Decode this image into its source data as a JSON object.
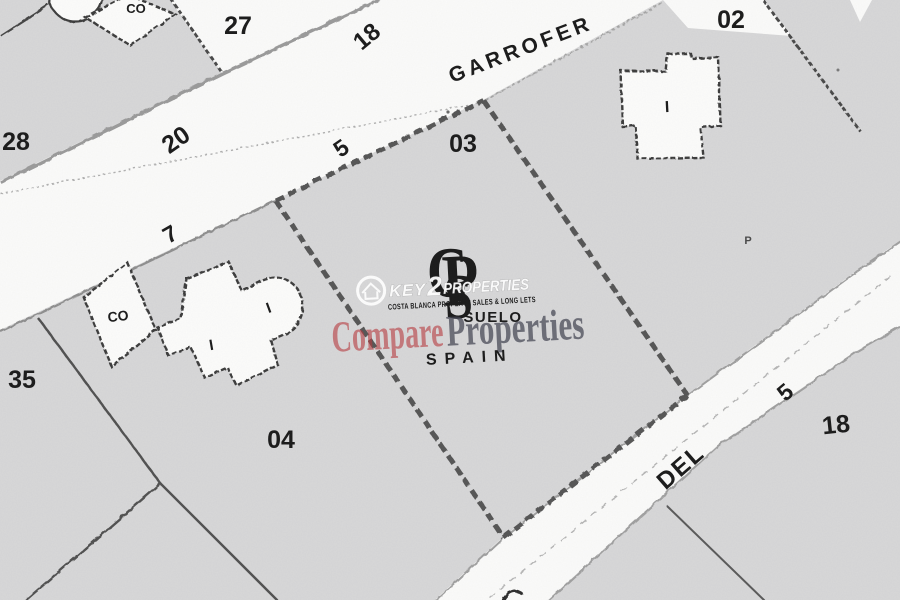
{
  "map": {
    "road_names": {
      "garrofer": "GARROFER",
      "del": "DEL"
    },
    "status_label": "SUELO",
    "plot_numbers": {
      "n27": "27",
      "n18_top": "18",
      "n02": "02",
      "n28": "28",
      "n20": "20",
      "n5_garrofer": "5",
      "n03": "03",
      "n7": "7",
      "n35": "35",
      "n04": "04",
      "n5_del": "5",
      "n18_bottom": "18"
    },
    "building_marks": {
      "co_top": "CO",
      "co_house": "CO",
      "storey": "I",
      "p": "P"
    }
  },
  "watermarks": {
    "monogram": {
      "c": "C",
      "p": "P",
      "s": "S"
    },
    "key2properties": {
      "key": "KEY",
      "two": "2",
      "properties": "PROPERTIES",
      "tagline": "COSTA BLANCA PROPERTY SALES & LONG LETS"
    },
    "compareproperties": {
      "compare": "Compare",
      "properties": "Properties",
      "spain": "SPAIN"
    }
  },
  "colors": {
    "plot_fill": "#d7d7d8",
    "road_fill": "#fbfbfa",
    "ink": "#1b1b1b",
    "boundary": "#4a4a4a",
    "highlight_dash": "#565656",
    "brand_red": "#b8444a",
    "brand_gray": "#474a57",
    "brand_yellow": "#d9a92c"
  }
}
